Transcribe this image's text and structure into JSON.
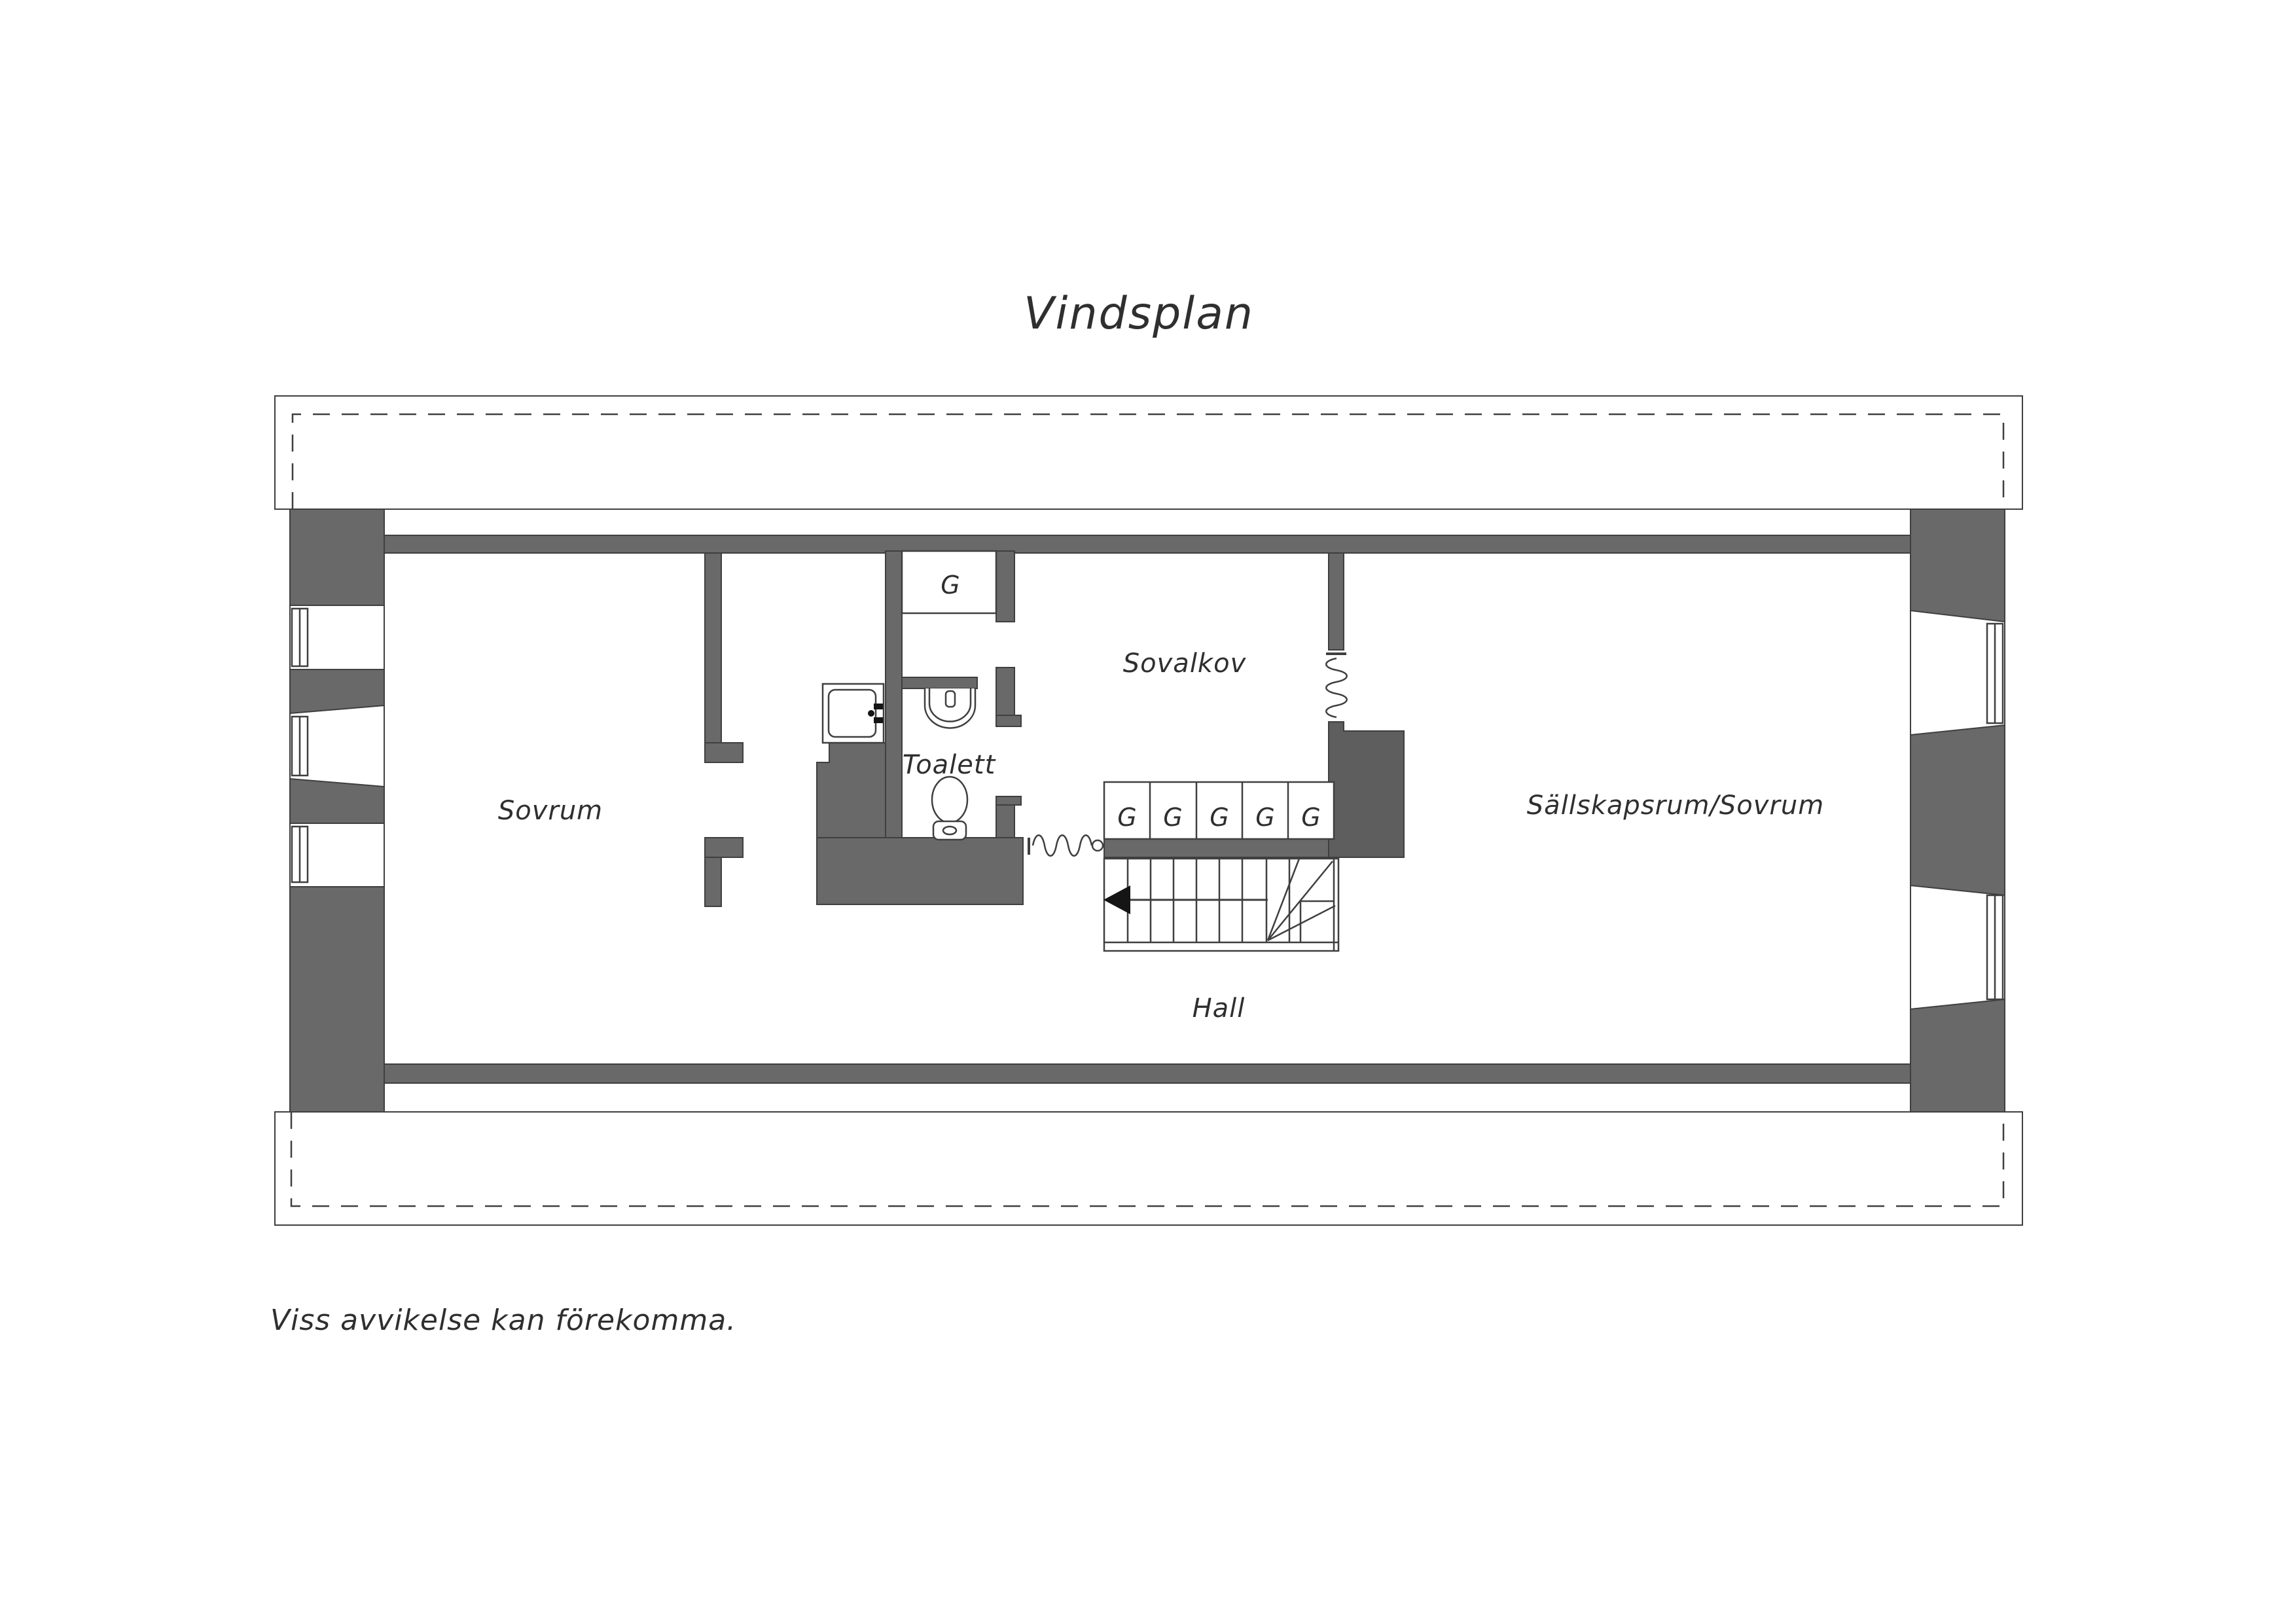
{
  "title": "Vindsplan",
  "disclaimer": "Viss avvikelse kan förekomma.",
  "rooms": {
    "sovrum": "Sovrum",
    "toalett": "Toalett",
    "sovalkov": "Sovalkov",
    "sallskapsrum": "Sällskapsrum/Sovrum",
    "hall": "Hall"
  },
  "wardrobe_label": "G",
  "icons": {
    "stair_direction": "stair-direction-arrow",
    "door_opening": "door-opening-squiggle"
  },
  "colors": {
    "background": "#ffffff",
    "wall": "#696969",
    "wall_dark": "#5e5e5e",
    "line": "#3f3f3f",
    "text": "#2f2f2f"
  }
}
